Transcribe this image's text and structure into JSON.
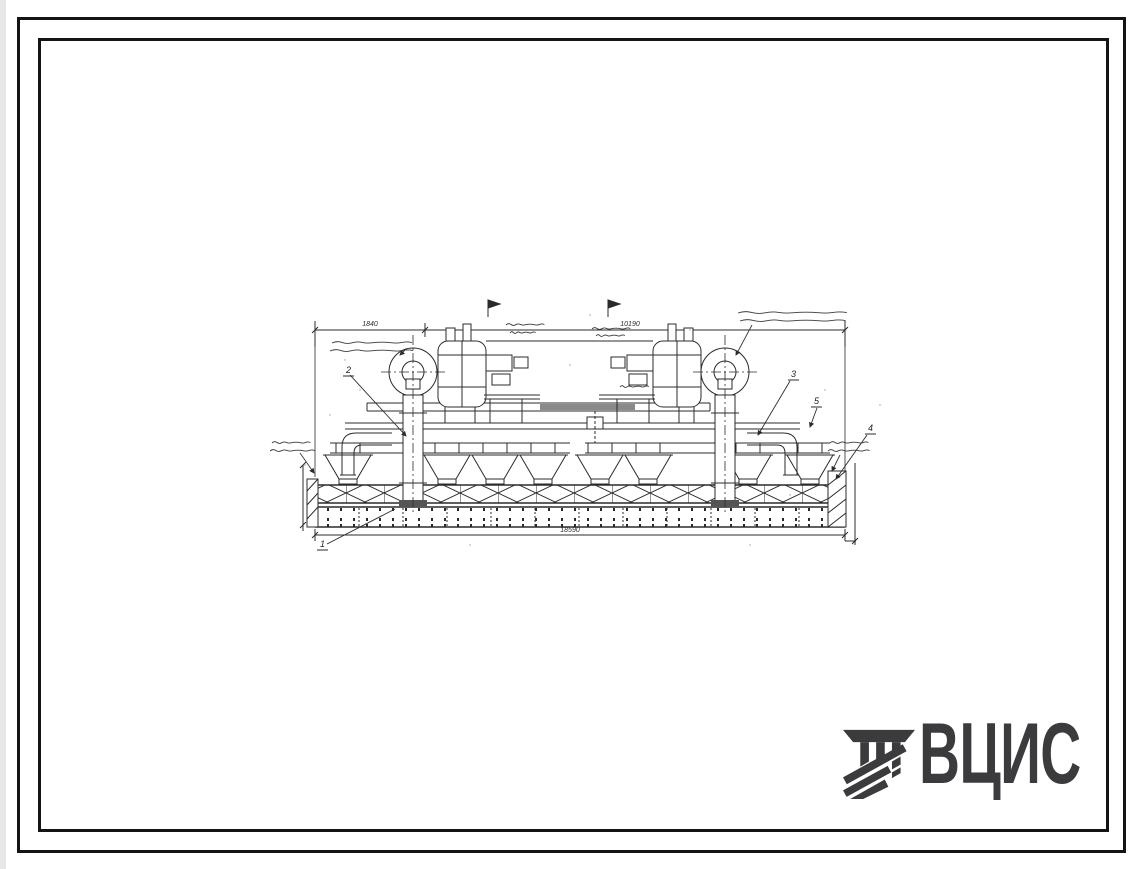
{
  "page": {
    "background": "#ffffff",
    "frame_border_color": "#141414"
  },
  "drawing": {
    "ink_color": "#2b2b2b",
    "dimension_labels": {
      "top_left": "1840",
      "top_span": "10190",
      "bottom_overall": "18590"
    },
    "callout_numbers": [
      "1",
      "2",
      "3",
      "4",
      "5"
    ]
  },
  "logo": {
    "text": "ВЦИС",
    "color": "#3b3b3d"
  }
}
